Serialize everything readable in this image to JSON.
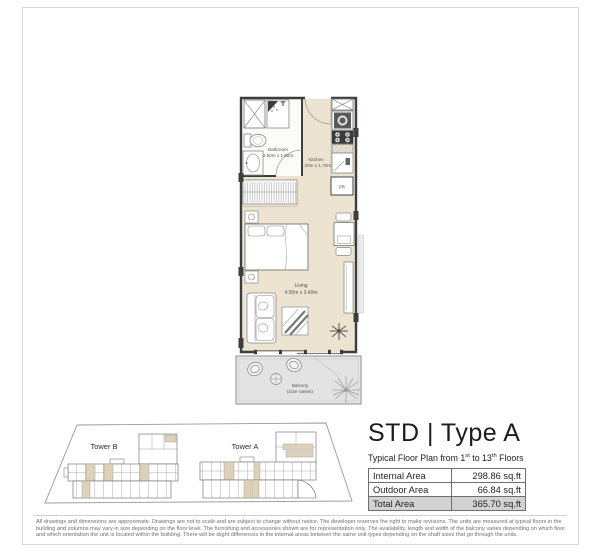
{
  "title": {
    "main": "STD | Type A",
    "subtitle_part1": "Typical Floor Plan from 1",
    "subtitle_sup1": "st",
    "subtitle_part2": " to 13",
    "subtitle_sup2": "th",
    "subtitle_part3": " Floors"
  },
  "area_table": {
    "rows": [
      {
        "label": "Internal Area",
        "value": "298.86 sq.ft"
      },
      {
        "label": "Outdoor Area",
        "value": "66.84 sq.ft"
      },
      {
        "label": "Total Area",
        "value": "365.70 sq.ft"
      }
    ]
  },
  "floorplan": {
    "bathroom": {
      "name": "Bathroom",
      "dims": "2.50m x 1.60m"
    },
    "kitchen": {
      "name": "Kitchen",
      "dims": "3.20m x 1.70m"
    },
    "living": {
      "name": "Living",
      "dims": "4.55m x 3.40m"
    },
    "balcony": {
      "name": "Balcony",
      "note": "(Size Varies)"
    },
    "fridge_label": "FR"
  },
  "keyplan": {
    "tower_b": "Tower B",
    "tower_a": "Tower A"
  },
  "disclaimer": "All drawings and dimensions are approximate. Drawings are not to scale and are subject to change without notice. The developer reserves the right to make revisions. The units are measured at typical floors in the building and columns may vary in size depending on the floor level. The furnishing and accessories shown are for representation only. The availability, length and width of the balcony varies depending on which floor and which orientation the unit is located within the building. There will be slight differences in the internal areas between the same unit types depending on the shaft sizes that go through the units.",
  "colors": {
    "floor_beige": "#ece3d1",
    "balcony_grey": "#e3e3e3",
    "wall_dark": "#3d3d3d",
    "highlight_unit": "#ddd2b8",
    "total_row_grey": "#d2d2d2"
  }
}
